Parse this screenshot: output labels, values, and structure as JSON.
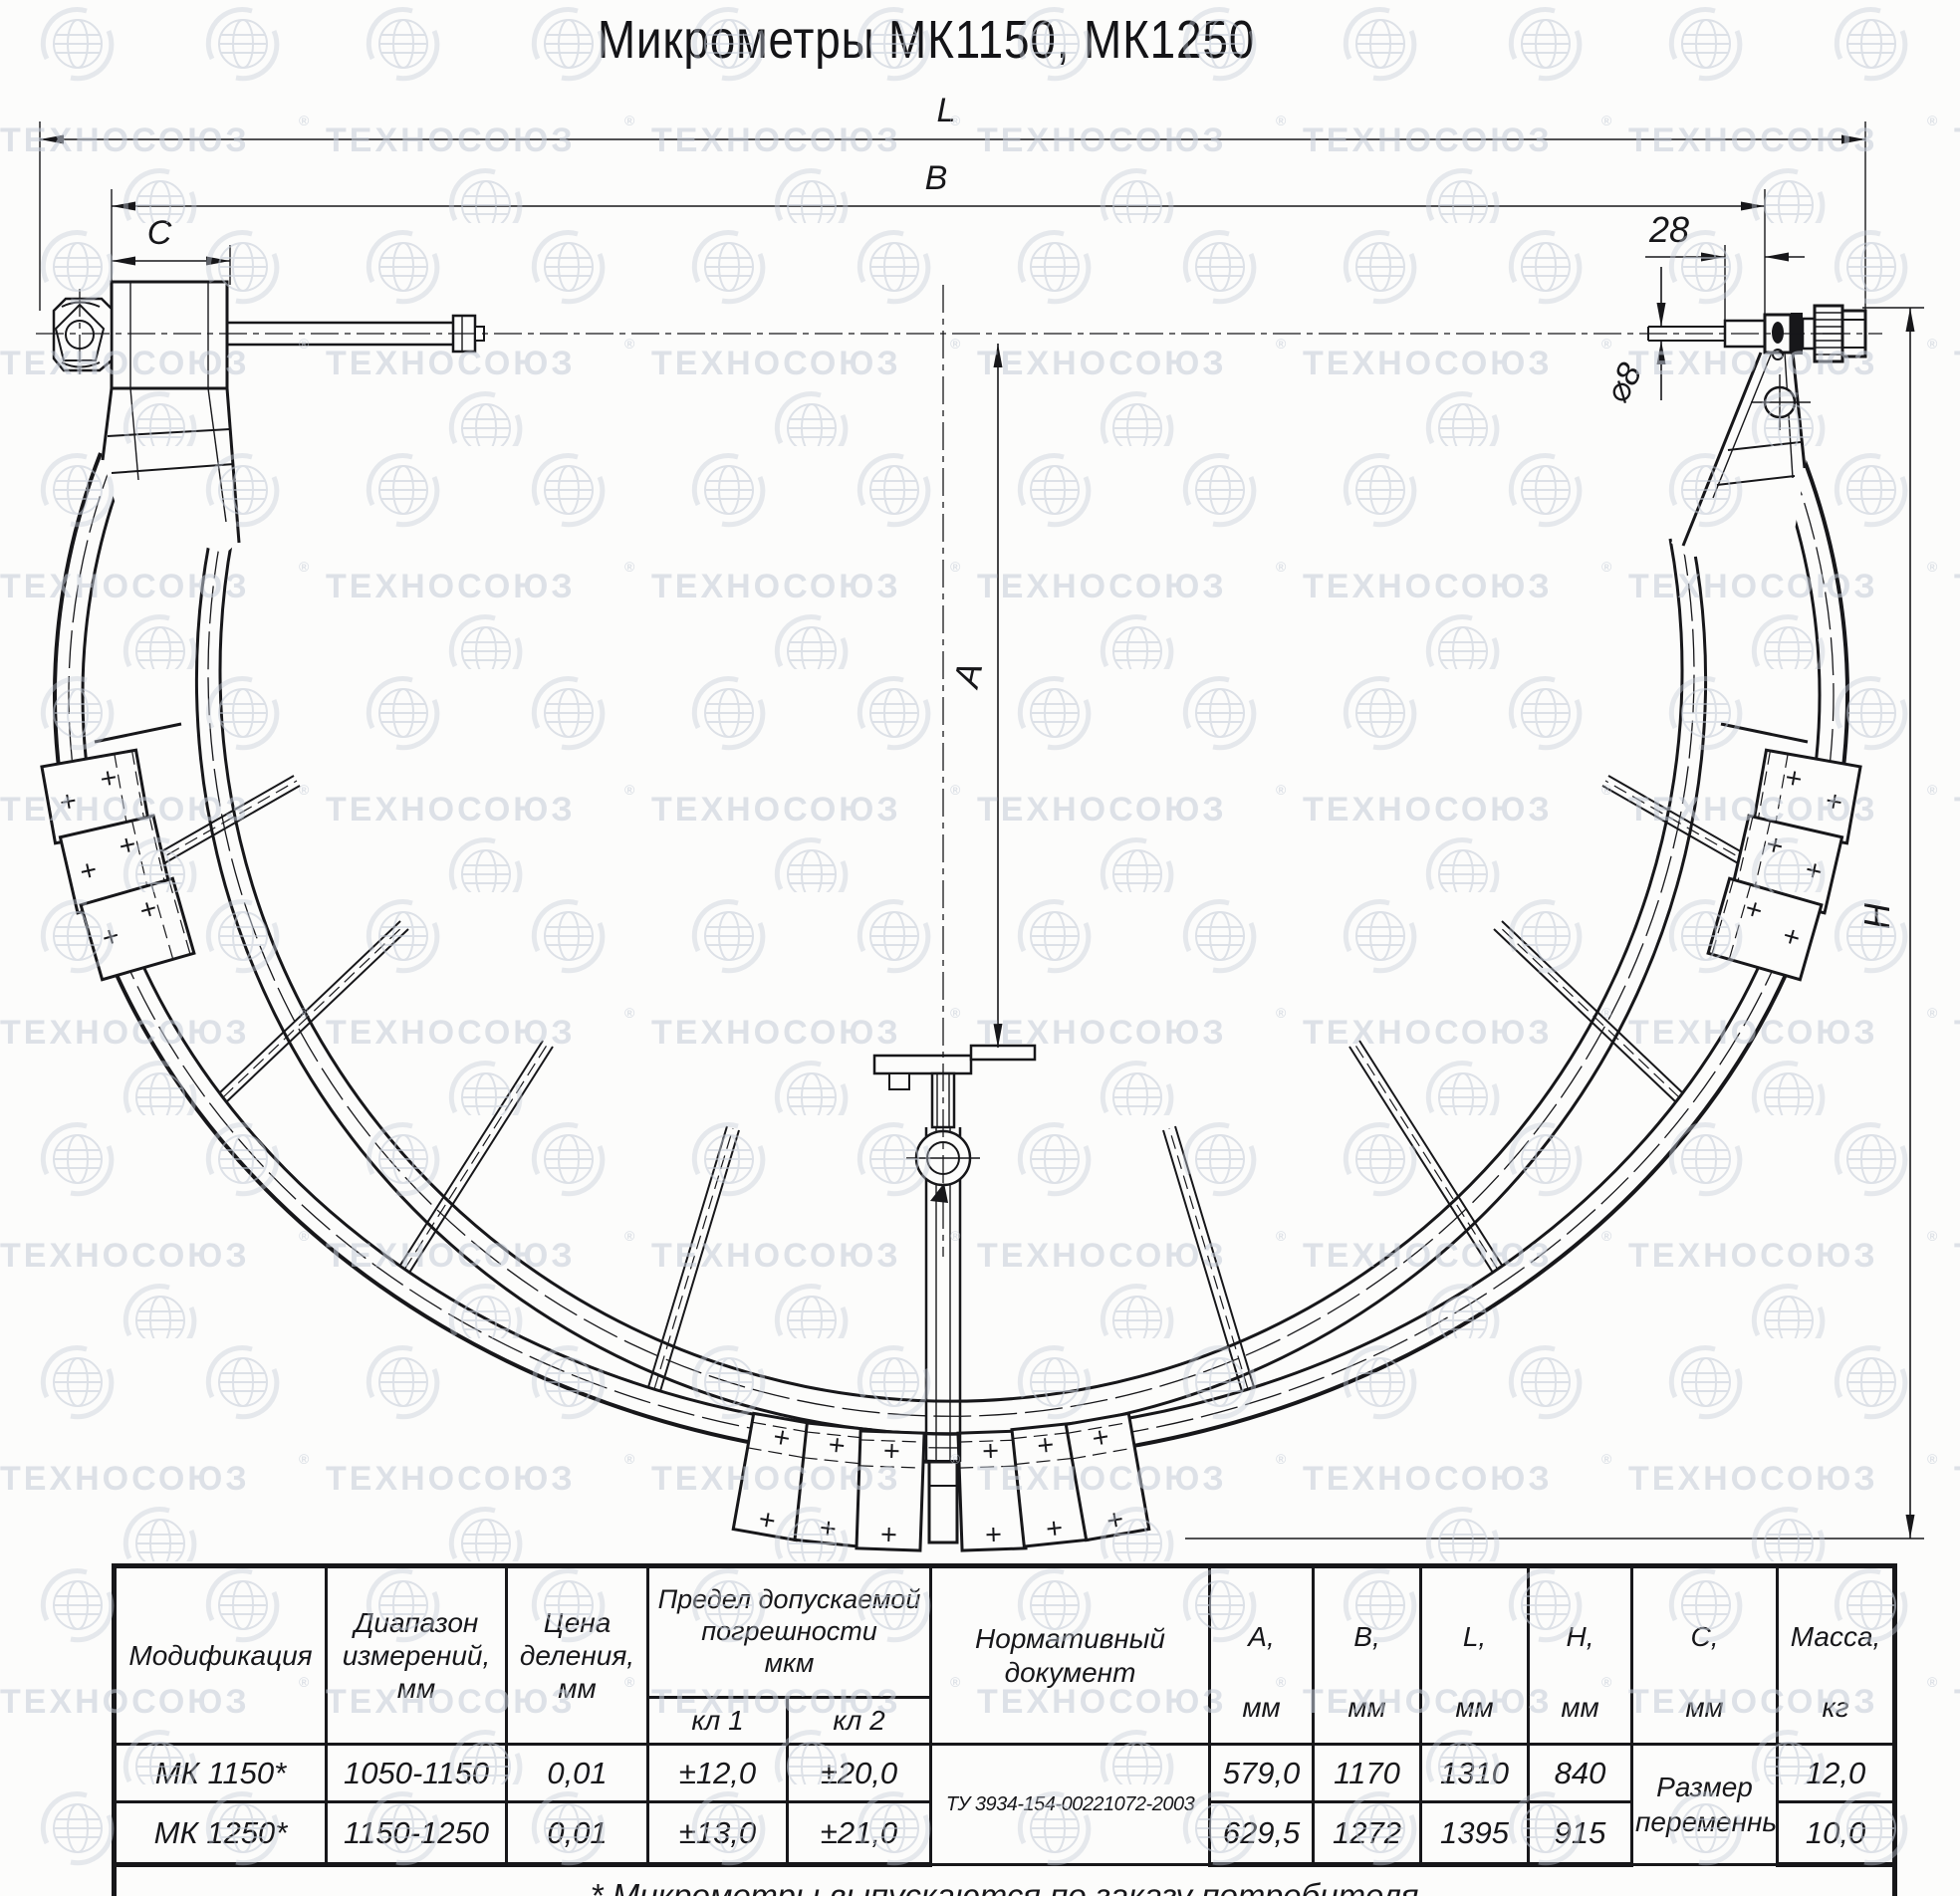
{
  "title": "Микрометры МК1150, МК1250",
  "watermark": {
    "text": "ТЕХНОСОЮЗ",
    "symbol": "®"
  },
  "dimensions": {
    "overall_length": "L",
    "body_length": "B",
    "anvil_offset": "C",
    "head_offset": "28",
    "spindle_diameter": "⌀8",
    "measuring_depth": "A",
    "frame_height": "H"
  },
  "table": {
    "headers": {
      "modification": "Модификация",
      "range": "Диапазон\nизмерений,\nмм",
      "division": "Цена\nделения,\nмм",
      "error_limit": "Предел допускаемой\nпогрешности\nмкм",
      "class1": "кл 1",
      "class2": "кл 2",
      "document": "Нормативный\nдокумент",
      "dims": [
        {
          "name": "А,",
          "unit": "мм"
        },
        {
          "name": "В,",
          "unit": "мм"
        },
        {
          "name": "L,",
          "unit": "мм"
        },
        {
          "name": "Н,",
          "unit": "мм"
        },
        {
          "name": "С,",
          "unit": "мм"
        },
        {
          "name": "Масса,",
          "unit": "кг"
        }
      ]
    },
    "document_value": "ТУ 3934-154-00221072-2003",
    "c_value": "Размер\nпеременный",
    "rows": [
      {
        "model": "МК 1150*",
        "range": "1050-1150",
        "division": "0,01",
        "class1": "±12,0",
        "class2": "±20,0",
        "a": "579,0",
        "b": "1170",
        "l": "1310",
        "h": "840",
        "mass": "12,0"
      },
      {
        "model": "МК 1250*",
        "range": "1150-1250",
        "division": "0,01",
        "class1": "±13,0",
        "class2": "±21,0",
        "a": "629,5",
        "b": "1272",
        "l": "1395",
        "h": "915",
        "mass": "10,0"
      }
    ],
    "footnote": "* Микрометры выпускаются по заказу потребителя"
  }
}
